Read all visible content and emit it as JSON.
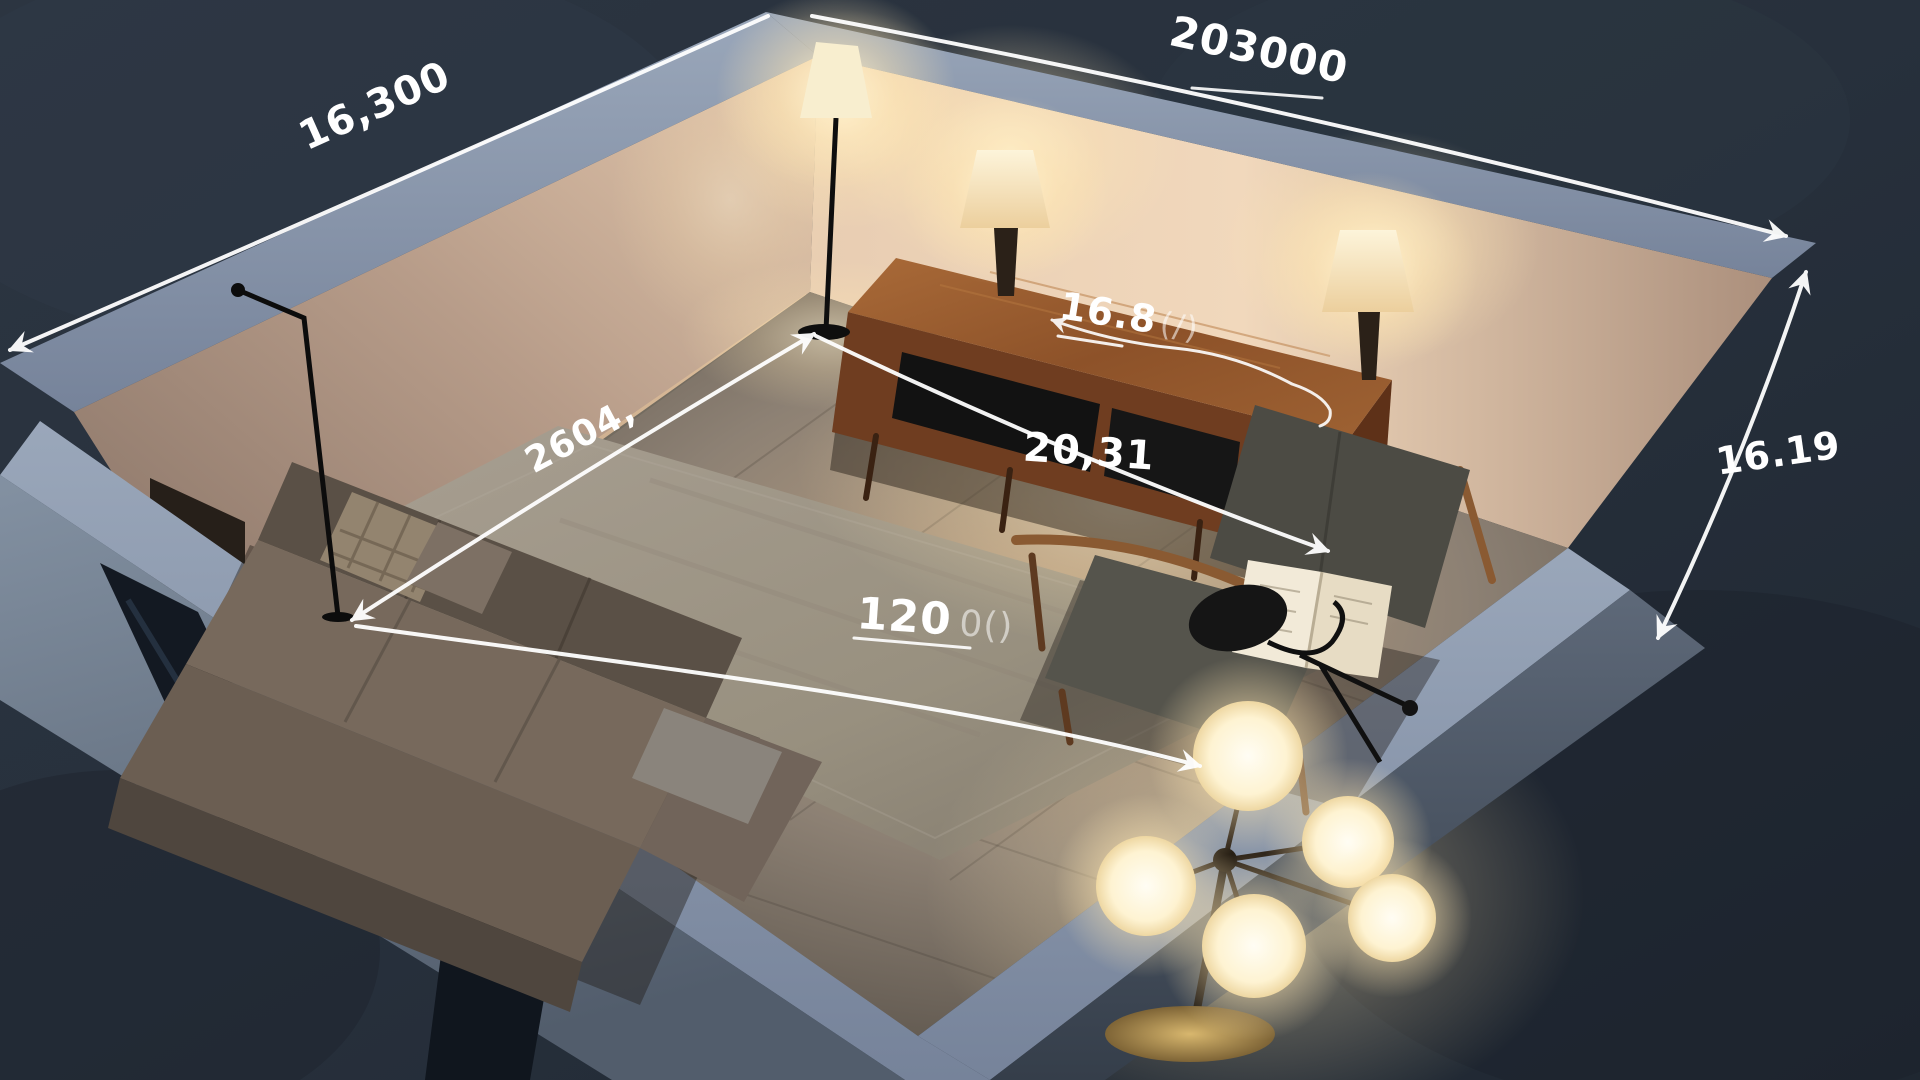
{
  "scene": {
    "type": "3d-cutaway-room-render",
    "description": "Night-time isometric cutaway render of a living room with hand-drawn white dimension annotations",
    "objects": [
      "sectional-sofa",
      "area-rug",
      "tv-console",
      "table-lamp-left",
      "table-lamp-right",
      "corner-floor-lamp",
      "left-floor-lamp",
      "armchair",
      "open-book",
      "task-lamp",
      "globe-floor-lamp",
      "glass-door-panel",
      "window-panel"
    ]
  },
  "annotations": {
    "top_left_wall": {
      "text": "16,300"
    },
    "top_right_wall": {
      "text": "203000"
    },
    "right_height": {
      "text": "16.19"
    },
    "left_wall_interior": {
      "text": "2604,"
    },
    "console_width": {
      "text": "16.8",
      "suffix": "(/)"
    },
    "floor_diagonal": {
      "text": "20,31"
    },
    "floor_length": {
      "text": "120",
      "suffix": "0()"
    }
  },
  "colors": {
    "ground_dark": "#27303c",
    "wall_top_band": "#8d9bb0",
    "wall_warm_light": "#f3d9bd",
    "wall_warm_shadow": "#8a7568",
    "floor_lit": "#c2a886",
    "floor_dark": "#4b453e",
    "rug": "#a39a8d",
    "sofa": "#77695c",
    "wood": "#8a5030",
    "lamp_glow": "#fff6dc",
    "annotation": "#ffffff"
  }
}
